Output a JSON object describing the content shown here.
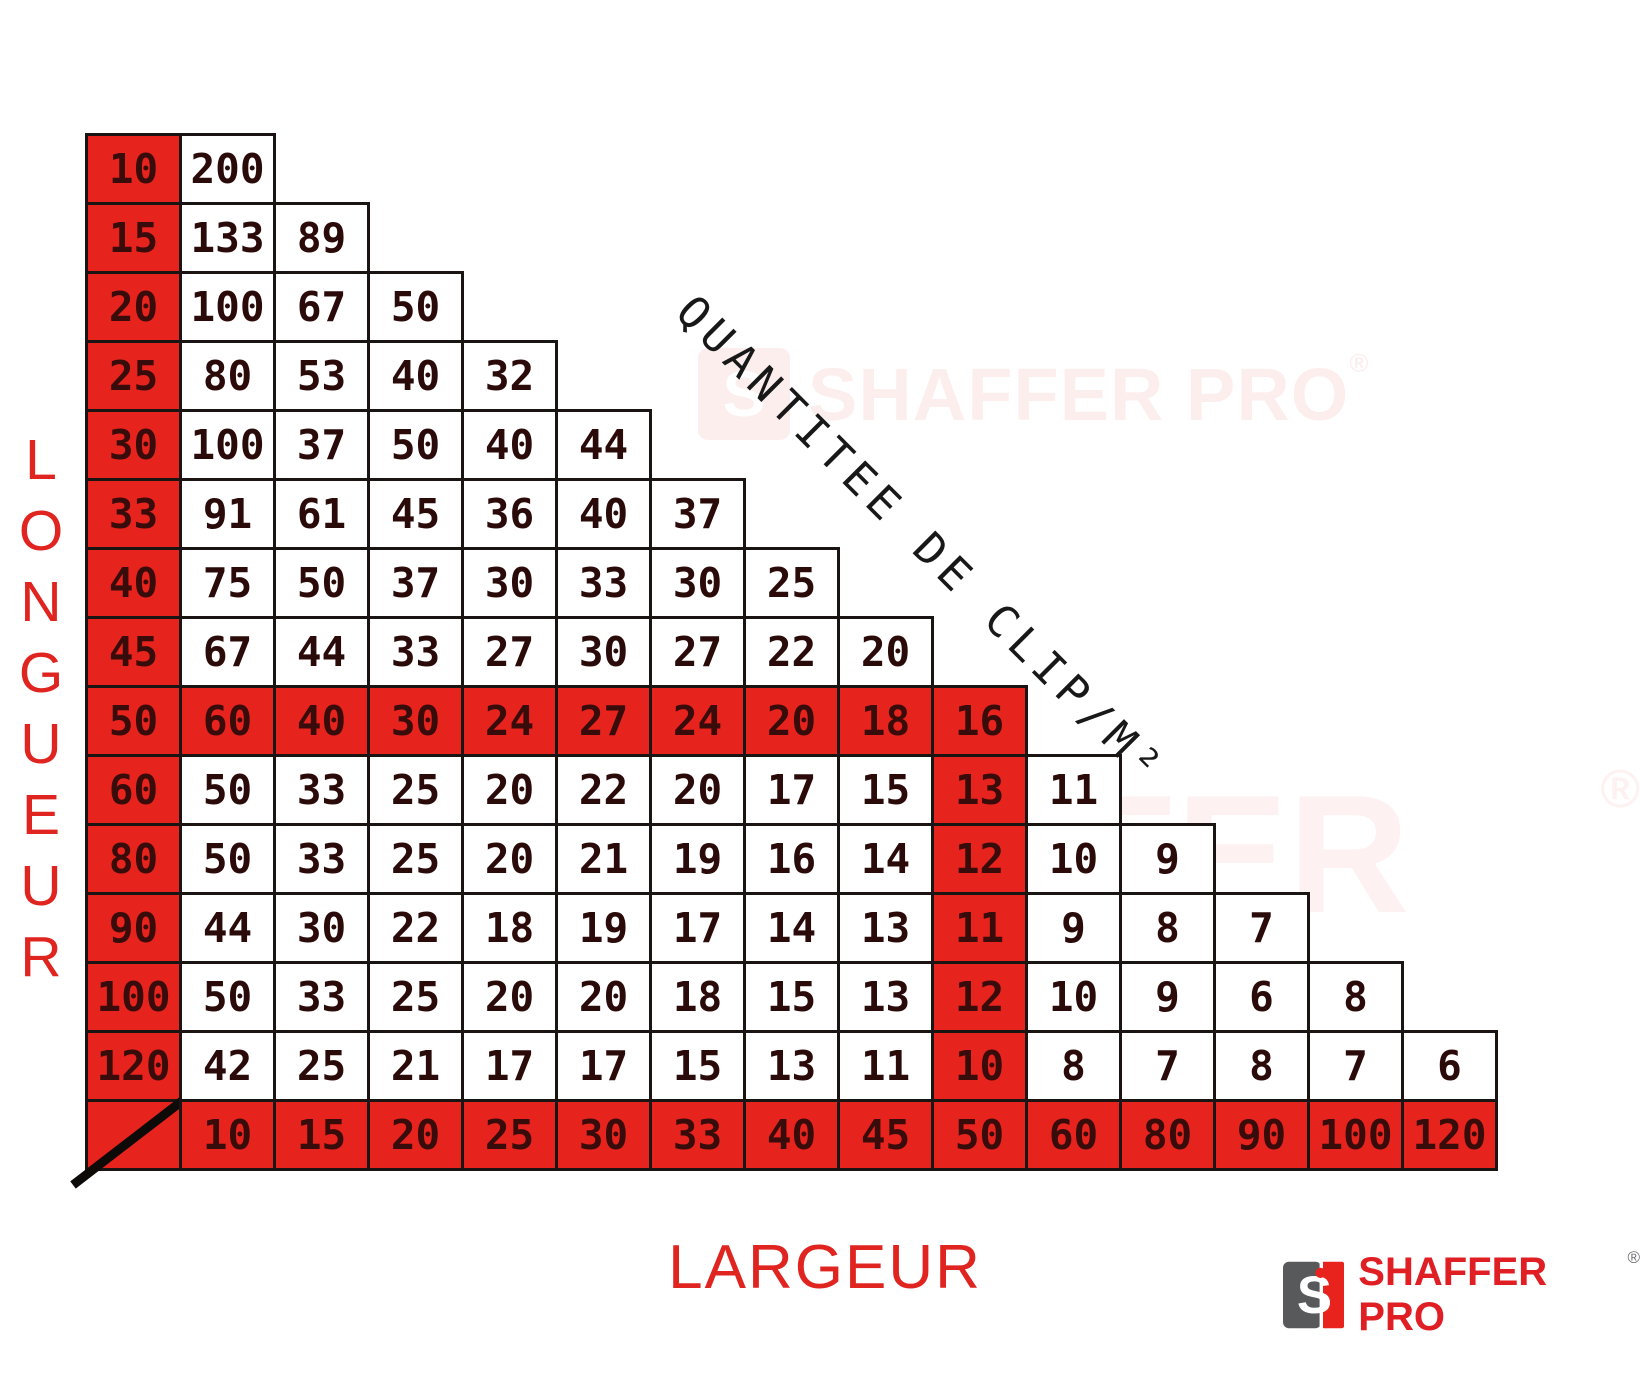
{
  "chart_data": {
    "type": "table",
    "title": "QUANTITEE DE CLIP/M²",
    "x_axis_label": "LARGEUR",
    "y_axis_label": "LONGUEUR",
    "col_headers": [
      "10",
      "15",
      "20",
      "25",
      "30",
      "33",
      "40",
      "45",
      "50",
      "60",
      "80",
      "90",
      "100",
      "120"
    ],
    "row_headers": [
      "10",
      "15",
      "20",
      "25",
      "30",
      "33",
      "40",
      "45",
      "50",
      "60",
      "80",
      "90",
      "100",
      "120"
    ],
    "rows": [
      [
        200
      ],
      [
        133,
        89
      ],
      [
        100,
        67,
        50
      ],
      [
        80,
        53,
        40,
        32
      ],
      [
        100,
        37,
        50,
        40,
        44
      ],
      [
        91,
        61,
        45,
        36,
        40,
        37
      ],
      [
        75,
        50,
        37,
        30,
        33,
        30,
        25
      ],
      [
        67,
        44,
        33,
        27,
        30,
        27,
        22,
        20
      ],
      [
        60,
        40,
        30,
        24,
        27,
        24,
        20,
        18,
        16
      ],
      [
        50,
        33,
        25,
        20,
        22,
        20,
        17,
        15,
        13,
        11
      ],
      [
        50,
        33,
        25,
        20,
        21,
        19,
        16,
        14,
        12,
        10,
        9
      ],
      [
        44,
        30,
        22,
        18,
        19,
        17,
        14,
        13,
        11,
        9,
        8,
        7
      ],
      [
        50,
        33,
        25,
        20,
        20,
        18,
        15,
        13,
        12,
        10,
        9,
        6,
        8
      ],
      [
        42,
        25,
        21,
        17,
        17,
        15,
        13,
        11,
        10,
        8,
        7,
        8,
        7,
        6
      ]
    ],
    "highlighted_row_header": "50",
    "highlighted_col_header": "50",
    "grid": true,
    "legend_position": "none"
  },
  "branding": {
    "logo_text": "SHAFFER PRO",
    "logo_initial": "S",
    "registered_mark": "®",
    "watermark_text": "SHAFFER PRO"
  },
  "colors": {
    "highlight_red": "#e7231d",
    "axis_label_red": "#e02420",
    "cell_text_dark": "#2b0a0a",
    "border_black": "#1a1412",
    "logo_gray": "#58595b",
    "logo_red": "#e8231d"
  }
}
